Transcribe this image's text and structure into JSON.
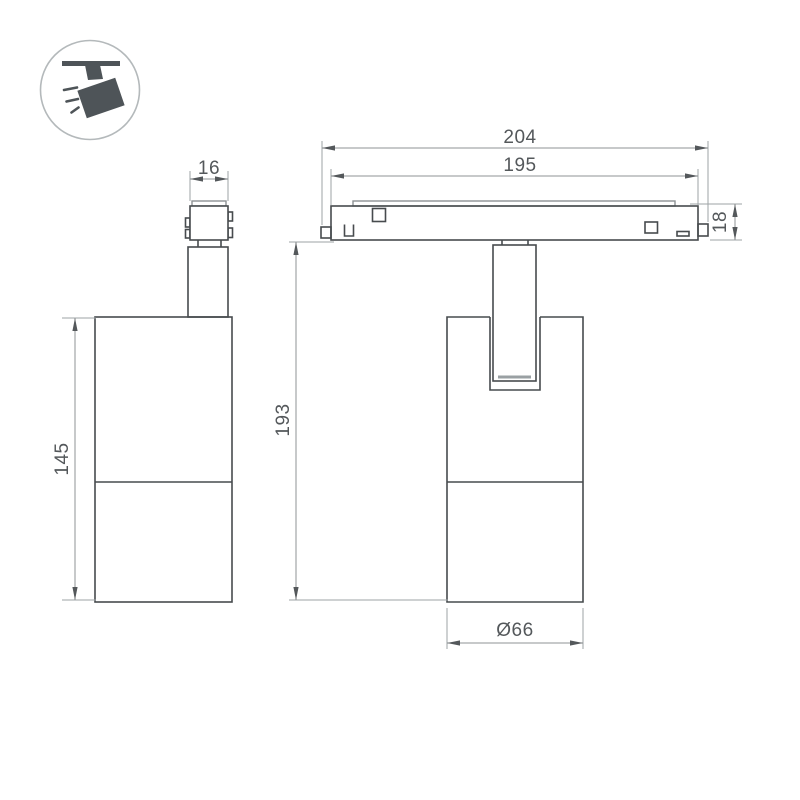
{
  "drawing": {
    "type": "technical-dimension-drawing",
    "subject": "magnetic-track-spotlight",
    "icon": "ceiling-track-spotlight-icon",
    "dimensions": {
      "adapter_width": "16",
      "body_height": "145",
      "track_length_overall": "204",
      "track_length_body": "195",
      "track_height": "18",
      "overall_height": "193",
      "body_diameter": "Ø66"
    },
    "colors": {
      "background": "#ffffff",
      "object_line": "#474b4e",
      "dimension_line": "#8f9396",
      "text": "#54585b",
      "icon_fill": "#4e5458",
      "icon_ring": "#b4b9bb"
    }
  }
}
